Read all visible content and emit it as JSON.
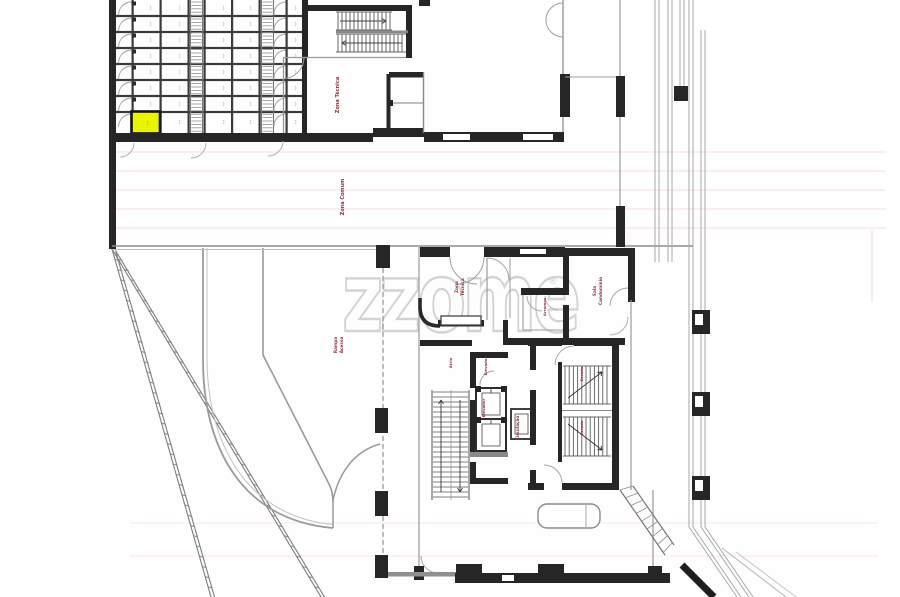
{
  "document": {
    "kind": "scanned architectural basement floor plan",
    "title": "floor-plan-scan"
  },
  "watermark": {
    "text": "zzome",
    "registered": "®",
    "color": "#d3d3d3"
  },
  "colors": {
    "wall": "#262626",
    "wall_dark": "#3a3a3a",
    "gray": "#979797",
    "light": "#b8b8b8",
    "label": "#8b3444",
    "highlight": "#e9f400",
    "scanline": "#e3b6c8"
  },
  "highlighted_unit": {
    "description": "storage unit highlighted yellow",
    "color": "#e9f400"
  },
  "storage": {
    "rows": 8,
    "cell_mark": "···",
    "columns": [
      "A",
      "B",
      "C",
      "D",
      "E"
    ]
  },
  "labels": [
    {
      "id": "tech-room-upper",
      "text": "Zona Técnica",
      "x": 339,
      "y": 95,
      "size": 5
    },
    {
      "id": "common-zone",
      "text": "Zona Comum",
      "x": 344,
      "y": 197,
      "size": 5
    },
    {
      "id": "ramp-1",
      "text": "Rampa",
      "x": 337,
      "y": 345,
      "size": 4.2
    },
    {
      "id": "ramp-2",
      "text": "Acesso",
      "x": 343,
      "y": 345,
      "size": 4.2
    },
    {
      "id": "lower-tech-1",
      "text": "Zona",
      "x": 458,
      "y": 287,
      "size": 4.2
    },
    {
      "id": "lower-tech-2",
      "text": "Técnica",
      "x": 464,
      "y": 287,
      "size": 4.2
    },
    {
      "id": "condo-room-1",
      "text": "Sala",
      "x": 596,
      "y": 291,
      "size": 4.2
    },
    {
      "id": "condo-room-2",
      "text": "Condomínio",
      "x": 602,
      "y": 291,
      "size": 4.2
    },
    {
      "id": "small-storage",
      "text": "Arrumos",
      "x": 546,
      "y": 307,
      "size": 3.8
    },
    {
      "id": "circulation",
      "text": "Circulação",
      "x": 519,
      "y": 428,
      "size": 4.2
    },
    {
      "id": "elevator-top",
      "text": "Elevador",
      "x": 487,
      "y": 366,
      "size": 3.8
    },
    {
      "id": "elevator-side",
      "text": "Elevador",
      "x": 485,
      "y": 408,
      "size": 3.8
    },
    {
      "id": "stairs-upper",
      "text": "Escada",
      "x": 583,
      "y": 374,
      "size": 3.8
    },
    {
      "id": "stairs-lower",
      "text": "Escada",
      "x": 583,
      "y": 428,
      "size": 3.8
    },
    {
      "id": "atrium",
      "text": "Átrio",
      "x": 452,
      "y": 363,
      "size": 3.8
    }
  ]
}
